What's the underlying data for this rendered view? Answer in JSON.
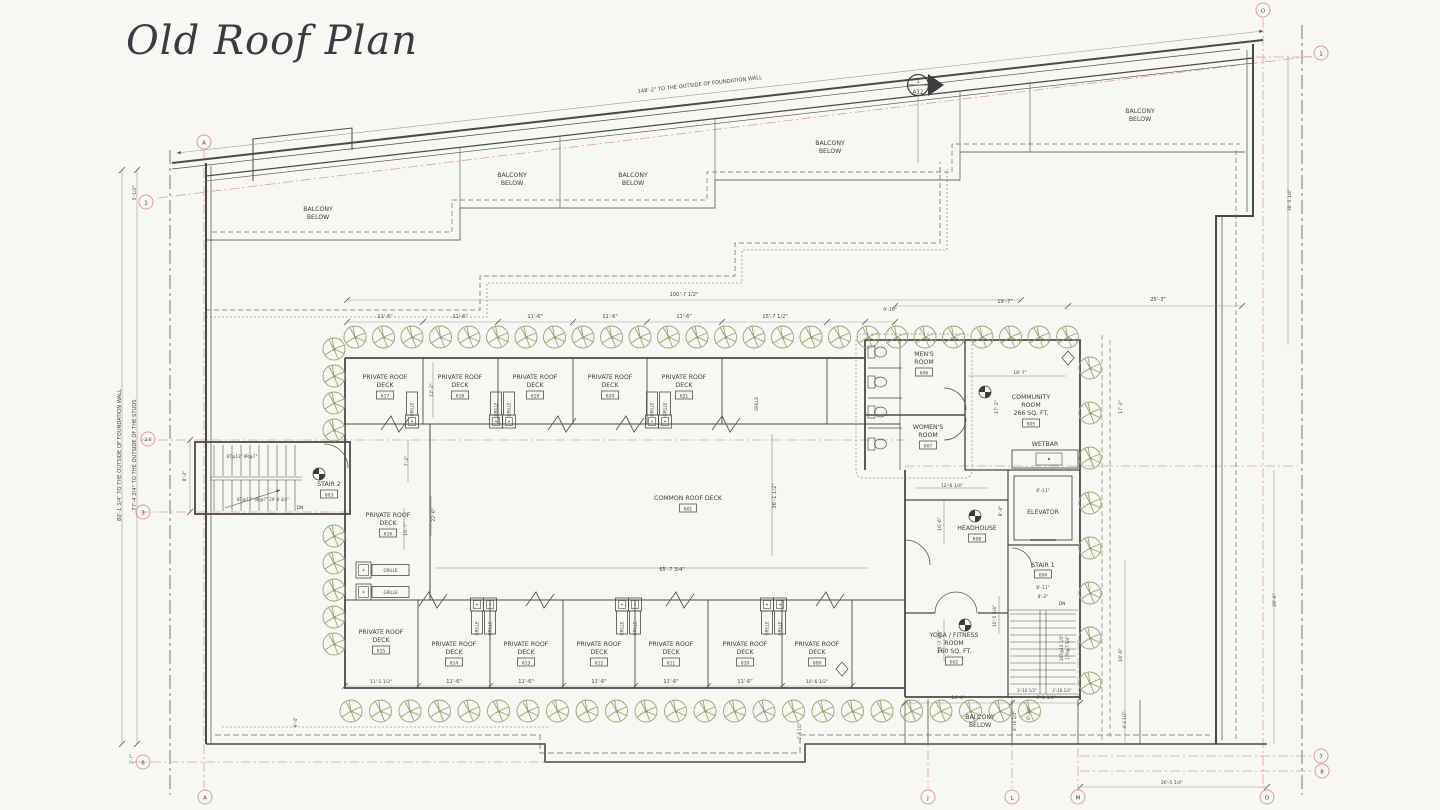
{
  "title": "Old Roof Plan",
  "colors": {
    "background": "#f7f7f4",
    "ink": "#3d3d3d",
    "wall": "#4a4a4a",
    "grid_pink": "#dfa09a",
    "tree_green": "#9aa56e",
    "dim_gray": "#8f8f8f"
  },
  "labels": {
    "balcony_l1": "BALCONY",
    "balcony_l2": "BELOW",
    "private_l1": "PRIVATE ROOF",
    "private_l2": "DECK",
    "common_deck": "COMMON ROOF DECK",
    "common_num": "601",
    "grille": "GRILLE",
    "mens_l1": "MEN'S",
    "mens_l2": "ROOM",
    "mens_num": "606",
    "womens_l1": "WOMEN'S",
    "womens_l2": "ROOM",
    "womens_num": "607",
    "community_l1": "COMMUNITY",
    "community_l2": "ROOM",
    "community_l3": "266 SQ. FT.",
    "community_num": "605",
    "wetbar": "WETBAR",
    "elevator": "ELEVATOR",
    "headhouse": "HEADHOUSE",
    "headhouse_num": "608",
    "stair1": "STAIR 1",
    "stair1_num": "604",
    "stair2": "STAIR 2",
    "stair2_num": "603",
    "yoga_l1": "YOGA / FITNESS",
    "yoga_l2": "ROOM",
    "yoga_l3": "160 SQ. FT.",
    "yoga_num": "602",
    "dn": "DN",
    "stair2_run1": "8T@11\"  9R@7\"",
    "stair2_run2": "8T@11\" 9R@7\" 20'-4 3/4\"",
    "stair1_run1": "16T@10 1/2\"",
    "stair1_run2": "17R@7 1/4\""
  },
  "decks": {
    "top": [
      "617",
      "618",
      "619",
      "620",
      "621"
    ],
    "bottom": [
      "615",
      "614",
      "613",
      "612",
      "611",
      "610",
      "609"
    ],
    "left": "616"
  },
  "grid": {
    "a": "A",
    "n1": "1",
    "n26": "2.6",
    "n3": "3",
    "n7": "7",
    "n8": "8",
    "o": "O",
    "j": "J",
    "l": "L",
    "m": "M"
  },
  "section_marker": {
    "number": "1",
    "sheet": "A12"
  },
  "dims": {
    "foundation": "148'-2\" TO THE OUTSIDE OF FOUNDATION WALL",
    "left_foundation": "80'-1 3/4\" TO THE OUTSIDE OF FOUNDATION WALL",
    "left_studs": "77'-4 3/4\" TO THE OUTSIDE OF THE STUDS",
    "overall_top": "100'-7 1/2\"",
    "bay": "11'-6\"",
    "bay_top_last": "15'-7 1/2\"",
    "d910": "9'-10\"",
    "d197": "19'-7\"",
    "d253": "25'-3\"",
    "bay_bot_first": "11'-1 1/2\"",
    "bay_bot_last": "10'-6 1/2\"",
    "d122": "12'-2\"",
    "d72": "7'-2\"",
    "d187": "18'-7\"",
    "d226": "22'-6\"",
    "d6573": "65'-7 3/4\"",
    "d3612": "36'-1 1/2\"",
    "d172": "17'-2\"",
    "d82": "8'-2\"",
    "d611": "6'-11\"",
    "d811": "8'-11\"",
    "d1264": "12'-6 1/4\"",
    "d166": "16'-6\"",
    "d84": "8'-4\"",
    "d1473": "14'-7 3/4\"",
    "d1053": "10'-5 3/4\"",
    "d144": "14'-4\"",
    "d9134": "9'-1 3/4\"",
    "d81014": "8'-10 1/4\"",
    "d634": "6'-3/4\"",
    "d31012": "3'-10 1/2\"",
    "d26514": "26'-5 1/4\"",
    "d286": "28'-6\"",
    "d186": "18'-6\"",
    "d38514": "38'-5 1/4\"",
    "d512": "5'-1/2\"",
    "d27": "2'-7\"",
    "d94": "9'-4\"",
    "d4212": "4'-2 1/2\"",
    "d2612": "2'-6 1/2\""
  }
}
